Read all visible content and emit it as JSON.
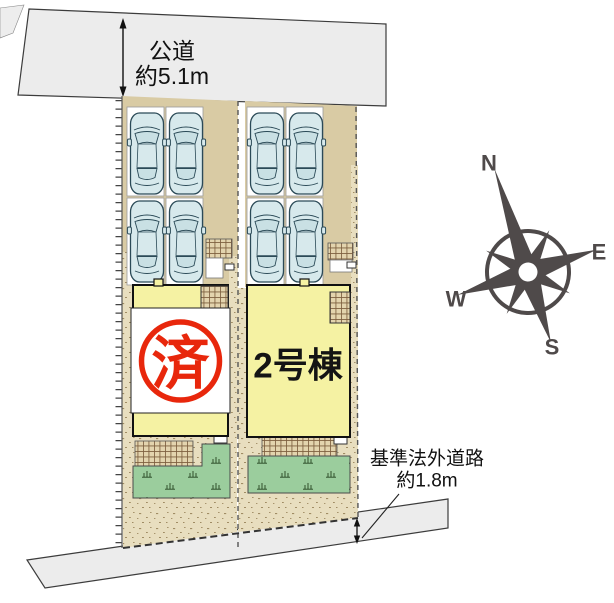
{
  "roads": {
    "public_road": {
      "label": "公道",
      "width_label": "約5.1m"
    },
    "non_certified_road": {
      "label": "基準法外道路",
      "width_label": "約1.8m"
    }
  },
  "lots": {
    "lot1": {
      "stamp": "済",
      "cars_parked": 4
    },
    "lot2": {
      "label": "2号棟",
      "cars_parked": 4
    }
  },
  "compass": {
    "n": "N",
    "e": "E",
    "s": "S",
    "w": "W"
  },
  "colors": {
    "road": "#ececec",
    "ground_stipple": "#e8debf",
    "driveway": "#d9cba4",
    "tile": "#e3d4ae",
    "building": "#f5f2a3",
    "garden": "#9bcd9d",
    "car_body": "#d7e9ec",
    "stamp_red": "#e8270c",
    "compass": "#4f4a4a",
    "outline": "#333333"
  }
}
